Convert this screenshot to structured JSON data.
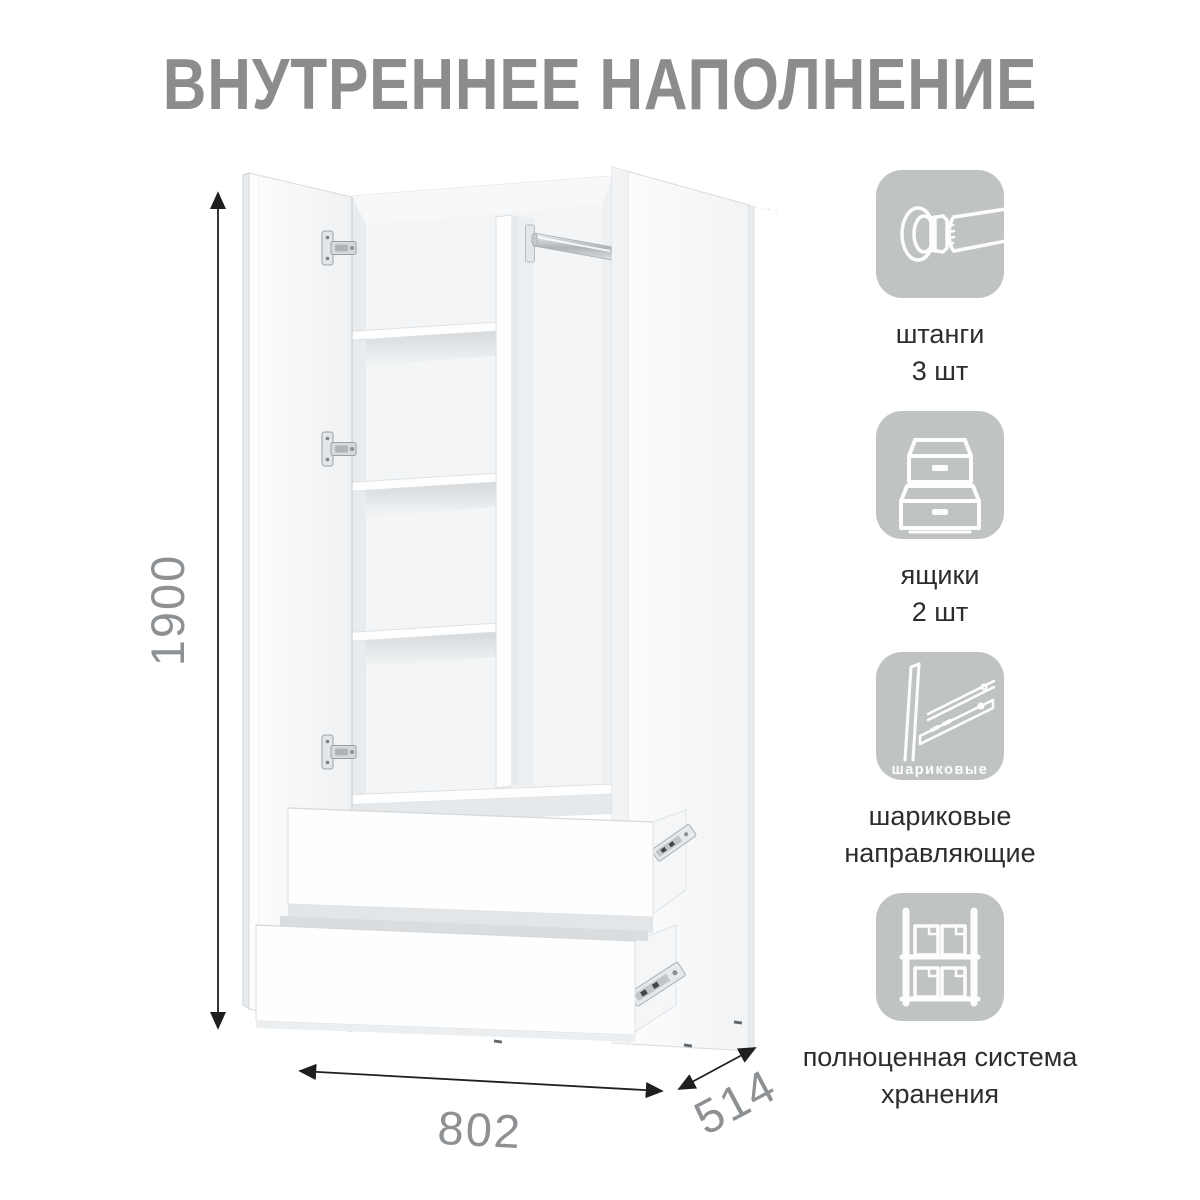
{
  "title": "ВНУТРЕННЕЕ НАПОЛНЕНИЕ",
  "wardrobe": {
    "height_mm": "1900",
    "width_mm": "802",
    "depth_mm": "514"
  },
  "features": [
    {
      "icon": "clothes-rod-icon",
      "lines": [
        "штанги",
        "3 шт"
      ]
    },
    {
      "icon": "drawers-icon",
      "lines": [
        "ящики",
        "2 шт"
      ]
    },
    {
      "icon": "ball-bearing-slides-icon",
      "icon_caption": "шариковые",
      "lines": [
        "шариковые",
        "направляющие"
      ]
    },
    {
      "icon": "storage-system-icon",
      "lines": [
        "полноценная система",
        "хранения"
      ]
    }
  ],
  "colors": {
    "icon_tile_bg": "#c0c3c4",
    "title_text": "#8c8c8c",
    "dimension_text": "#8e9194",
    "dimension_line": "#1f1f1f",
    "label_text": "#2d2d2d",
    "icon_line_art": "#fdfdfd"
  }
}
